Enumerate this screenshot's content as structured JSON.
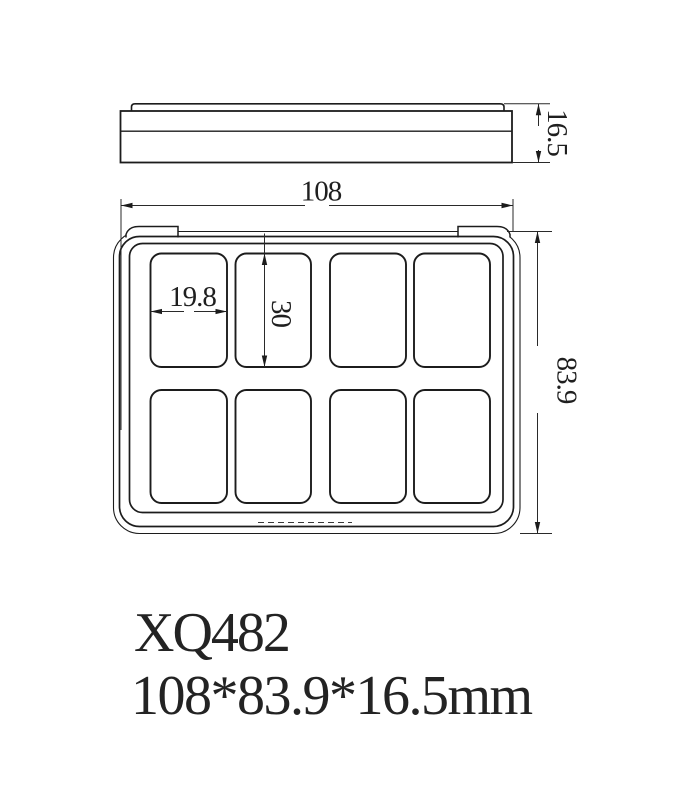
{
  "product": {
    "model": "XQ482",
    "size_label": "108*83.9*16.5mm"
  },
  "dimensions": {
    "overall_width": "108",
    "overall_depth": "83.9",
    "overall_height": "16.5",
    "pan_width": "19.8",
    "pan_height": "30"
  },
  "colors": {
    "line": "#1c1c1c",
    "text": "#1f1f1f",
    "background": "#ffffff"
  }
}
